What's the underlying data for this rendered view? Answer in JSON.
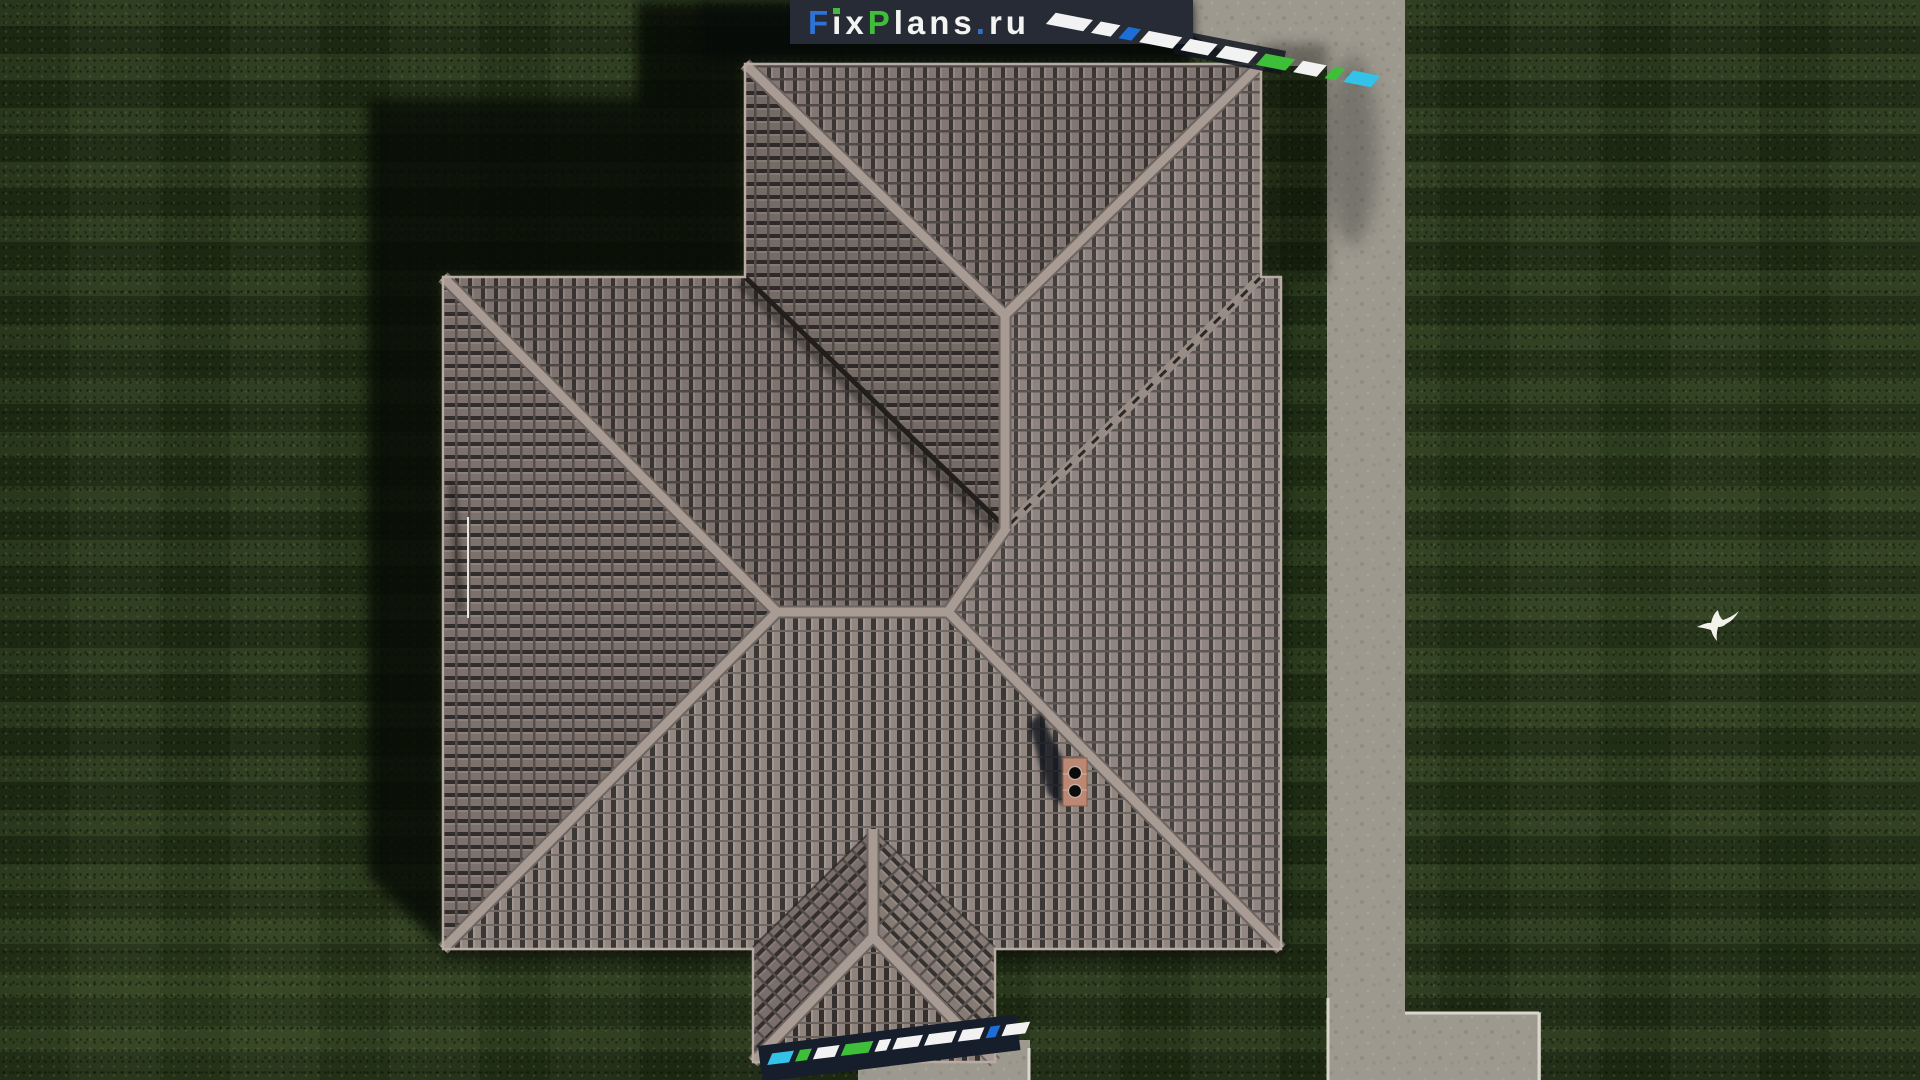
{
  "page": {
    "description": "Top-down aerial 3D render of a house with a brown hipped tile roof on a dark lawn, concrete walkway on the right, chimney on the roof, white bird over the grass, FixPlans.ru brand bar at top and diagonal brand watermarks"
  },
  "brand": {
    "full_text": "FixPlans.ru",
    "f": "F",
    "ix": "ix",
    "p": "P",
    "lans": "lans",
    "dot": ".",
    "ru": "ru",
    "bar_color": "#262b35",
    "blue": "#2e72d8",
    "green": "#3fbe3a",
    "white": "#f4f4f3",
    "cyan": "#35c2e8"
  },
  "scene": {
    "grass_color": "#223016",
    "tile_color": "#8b7f7a",
    "ridge_color": "#a79b94",
    "walkway_color": "#9d998f",
    "curb_color": "#d9d6cb",
    "shadow_color": "#070b05",
    "chimney_brick_color": "#bc8773",
    "bird_color": "#f2f1ec",
    "antenna_color": "#ece9e4"
  },
  "watermarks": {
    "top": {
      "angle_deg": 11,
      "segments": [
        {
          "color": "#f2f2f2",
          "w": 38
        },
        {
          "color": "#f2f2f2",
          "w": 20
        },
        {
          "color": "#1d6fd6",
          "w": 13
        },
        {
          "color": "#f2f2f2",
          "w": 34
        },
        {
          "color": "#f2f2f2",
          "w": 28
        },
        {
          "color": "#f2f2f2",
          "w": 33
        },
        {
          "color": "#3fbe3a",
          "w": 30
        },
        {
          "color": "#f2f2f2",
          "w": 24
        },
        {
          "color": "#3fbe3a",
          "w": 11
        },
        {
          "color": "#35c2e8",
          "w": 28
        }
      ]
    },
    "bottom": {
      "angle_deg": -7,
      "band_color": "#161d2b",
      "segments": [
        {
          "color": "#35c2e8",
          "w": 22
        },
        {
          "color": "#3fbe3a",
          "w": 12
        },
        {
          "color": "#f2f2f2",
          "w": 22
        },
        {
          "color": "#3fbe3a",
          "w": 28
        },
        {
          "color": "#f2f2f2",
          "w": 12
        },
        {
          "color": "#f2f2f2",
          "w": 26
        },
        {
          "color": "#f2f2f2",
          "w": 28
        },
        {
          "color": "#f2f2f2",
          "w": 22
        },
        {
          "color": "#1d6fd6",
          "w": 10
        },
        {
          "color": "#f2f2f2",
          "w": 24
        }
      ]
    }
  }
}
